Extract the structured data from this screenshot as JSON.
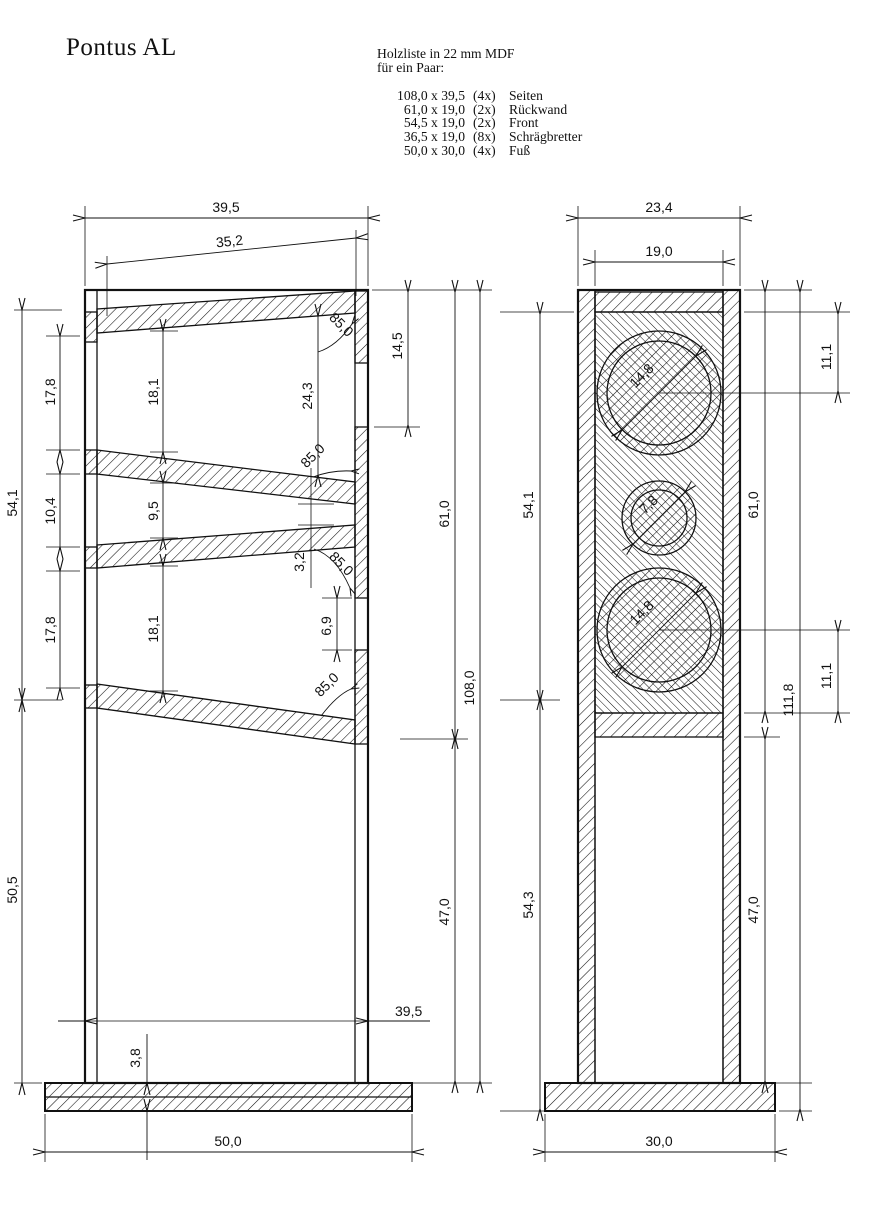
{
  "title": "Pontus AL",
  "parts_list": {
    "heading_line1": "Holzliste in 22 mm MDF",
    "heading_line2": "für ein Paar:",
    "items": [
      {
        "size": "108,0 x 39,5",
        "qty": "(4x)",
        "name": "Seiten"
      },
      {
        "size": "61,0 x 19,0",
        "qty": "(2x)",
        "name": "Rückwand"
      },
      {
        "size": "54,5 x 19,0",
        "qty": "(2x)",
        "name": "Front"
      },
      {
        "size": "36,5 x 19,0",
        "qty": "(8x)",
        "name": "Schrägbretter"
      },
      {
        "size": "50,0 x 30,0",
        "qty": "(4x)",
        "name": "Fuß"
      }
    ]
  },
  "side_view": {
    "dims": {
      "overall_width": "39,5",
      "baffle_length": "35,2",
      "top_port_height": "14,5",
      "left_upper_height": "54,1",
      "left_lower_height": "50,5",
      "front_seg_top": "17,8",
      "front_seg_mid": "10,4",
      "front_seg_bot": "17,8",
      "chamber_top": "18,1",
      "chamber_mid": "9,5",
      "chamber_bot": "18,1",
      "chamber_top_rear": "24,3",
      "rear_gap": "3,2",
      "rear_port_height": "6,9",
      "board_angle": "85,0",
      "rear_upper_height": "61,0",
      "total_height": "108,0",
      "rear_lower_height": "47,0",
      "inner_width_bottom": "39,5",
      "foot_thickness": "3,8",
      "foot_width": "50,0"
    }
  },
  "front_view": {
    "dims": {
      "overall_width": "23,4",
      "inner_width": "19,0",
      "top_driver_offset": "11,1",
      "top_driver_dia": "14,8",
      "mid_driver_dia": "7,8",
      "bottom_driver_dia": "14,8",
      "bottom_driver_offset": "11,1",
      "left_upper_height": "54,1",
      "left_lower_height": "54,3",
      "right_upper_height": "61,0",
      "total_height_with_foot": "111,8",
      "right_lower_height": "47,0",
      "foot_width": "30,0"
    }
  }
}
